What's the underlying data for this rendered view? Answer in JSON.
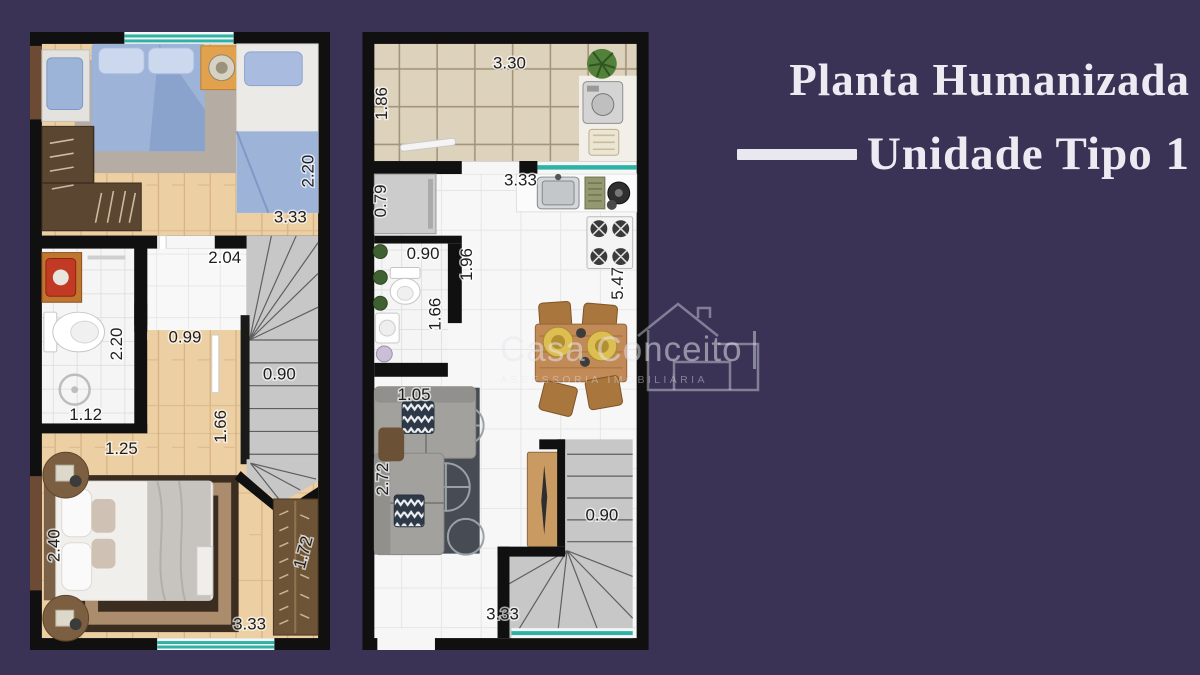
{
  "colors": {
    "background": "#3a3355",
    "title_text": "#edebf2",
    "window_accent": "#2fb2a6",
    "wall": "#101010",
    "stairs": "#c7c7c7",
    "wood_floor": "#eccfa2"
  },
  "title": {
    "line1": "Planta Humanizada",
    "line2": "Unidade Tipo 1"
  },
  "watermark": {
    "brand": "Casa Conceito",
    "subtitle": "ASSESSORIA IMOBILIÁRIA"
  },
  "plans": {
    "upper": {
      "label": "upper-floor-plan",
      "measurements": [
        {
          "value": "2.20",
          "x": 281,
          "y": 140,
          "rot": -90
        },
        {
          "value": "3.33",
          "x": 262,
          "y": 187,
          "rot": 0
        },
        {
          "value": "2.04",
          "x": 196,
          "y": 228,
          "rot": 0
        },
        {
          "value": "2.20",
          "x": 88,
          "y": 314,
          "rot": -90
        },
        {
          "value": "0.99",
          "x": 156,
          "y": 308,
          "rot": 0
        },
        {
          "value": "0.90",
          "x": 251,
          "y": 345,
          "rot": 0
        },
        {
          "value": "1.12",
          "x": 56,
          "y": 386,
          "rot": 0
        },
        {
          "value": "1.66",
          "x": 193,
          "y": 397,
          "rot": -90
        },
        {
          "value": "1.25",
          "x": 92,
          "y": 420,
          "rot": 0
        },
        {
          "value": "2.40",
          "x": 25,
          "y": 517,
          "rot": -90
        },
        {
          "value": "1.72",
          "x": 276,
          "y": 524,
          "rot": -75
        },
        {
          "value": "3.33",
          "x": 221,
          "y": 597,
          "rot": 0
        }
      ]
    },
    "ground": {
      "label": "ground-floor-plan",
      "measurements": [
        {
          "value": "3.30",
          "x": 148,
          "y": 32,
          "rot": 0
        },
        {
          "value": "1.86",
          "x": 20,
          "y": 72,
          "rot": -90
        },
        {
          "value": "0.79",
          "x": 19,
          "y": 170,
          "rot": -90
        },
        {
          "value": "3.33",
          "x": 159,
          "y": 150,
          "rot": 0
        },
        {
          "value": "0.90",
          "x": 61,
          "y": 224,
          "rot": 0
        },
        {
          "value": "1.96",
          "x": 106,
          "y": 234,
          "rot": -90
        },
        {
          "value": "1.66",
          "x": 74,
          "y": 284,
          "rot": -90
        },
        {
          "value": "5.47",
          "x": 258,
          "y": 253,
          "rot": -90
        },
        {
          "value": "1.05",
          "x": 52,
          "y": 366,
          "rot": 0
        },
        {
          "value": "2.72",
          "x": 21,
          "y": 450,
          "rot": -90
        },
        {
          "value": "0.90",
          "x": 241,
          "y": 487,
          "rot": 0
        },
        {
          "value": "3.33",
          "x": 141,
          "y": 587,
          "rot": 0
        }
      ]
    }
  }
}
